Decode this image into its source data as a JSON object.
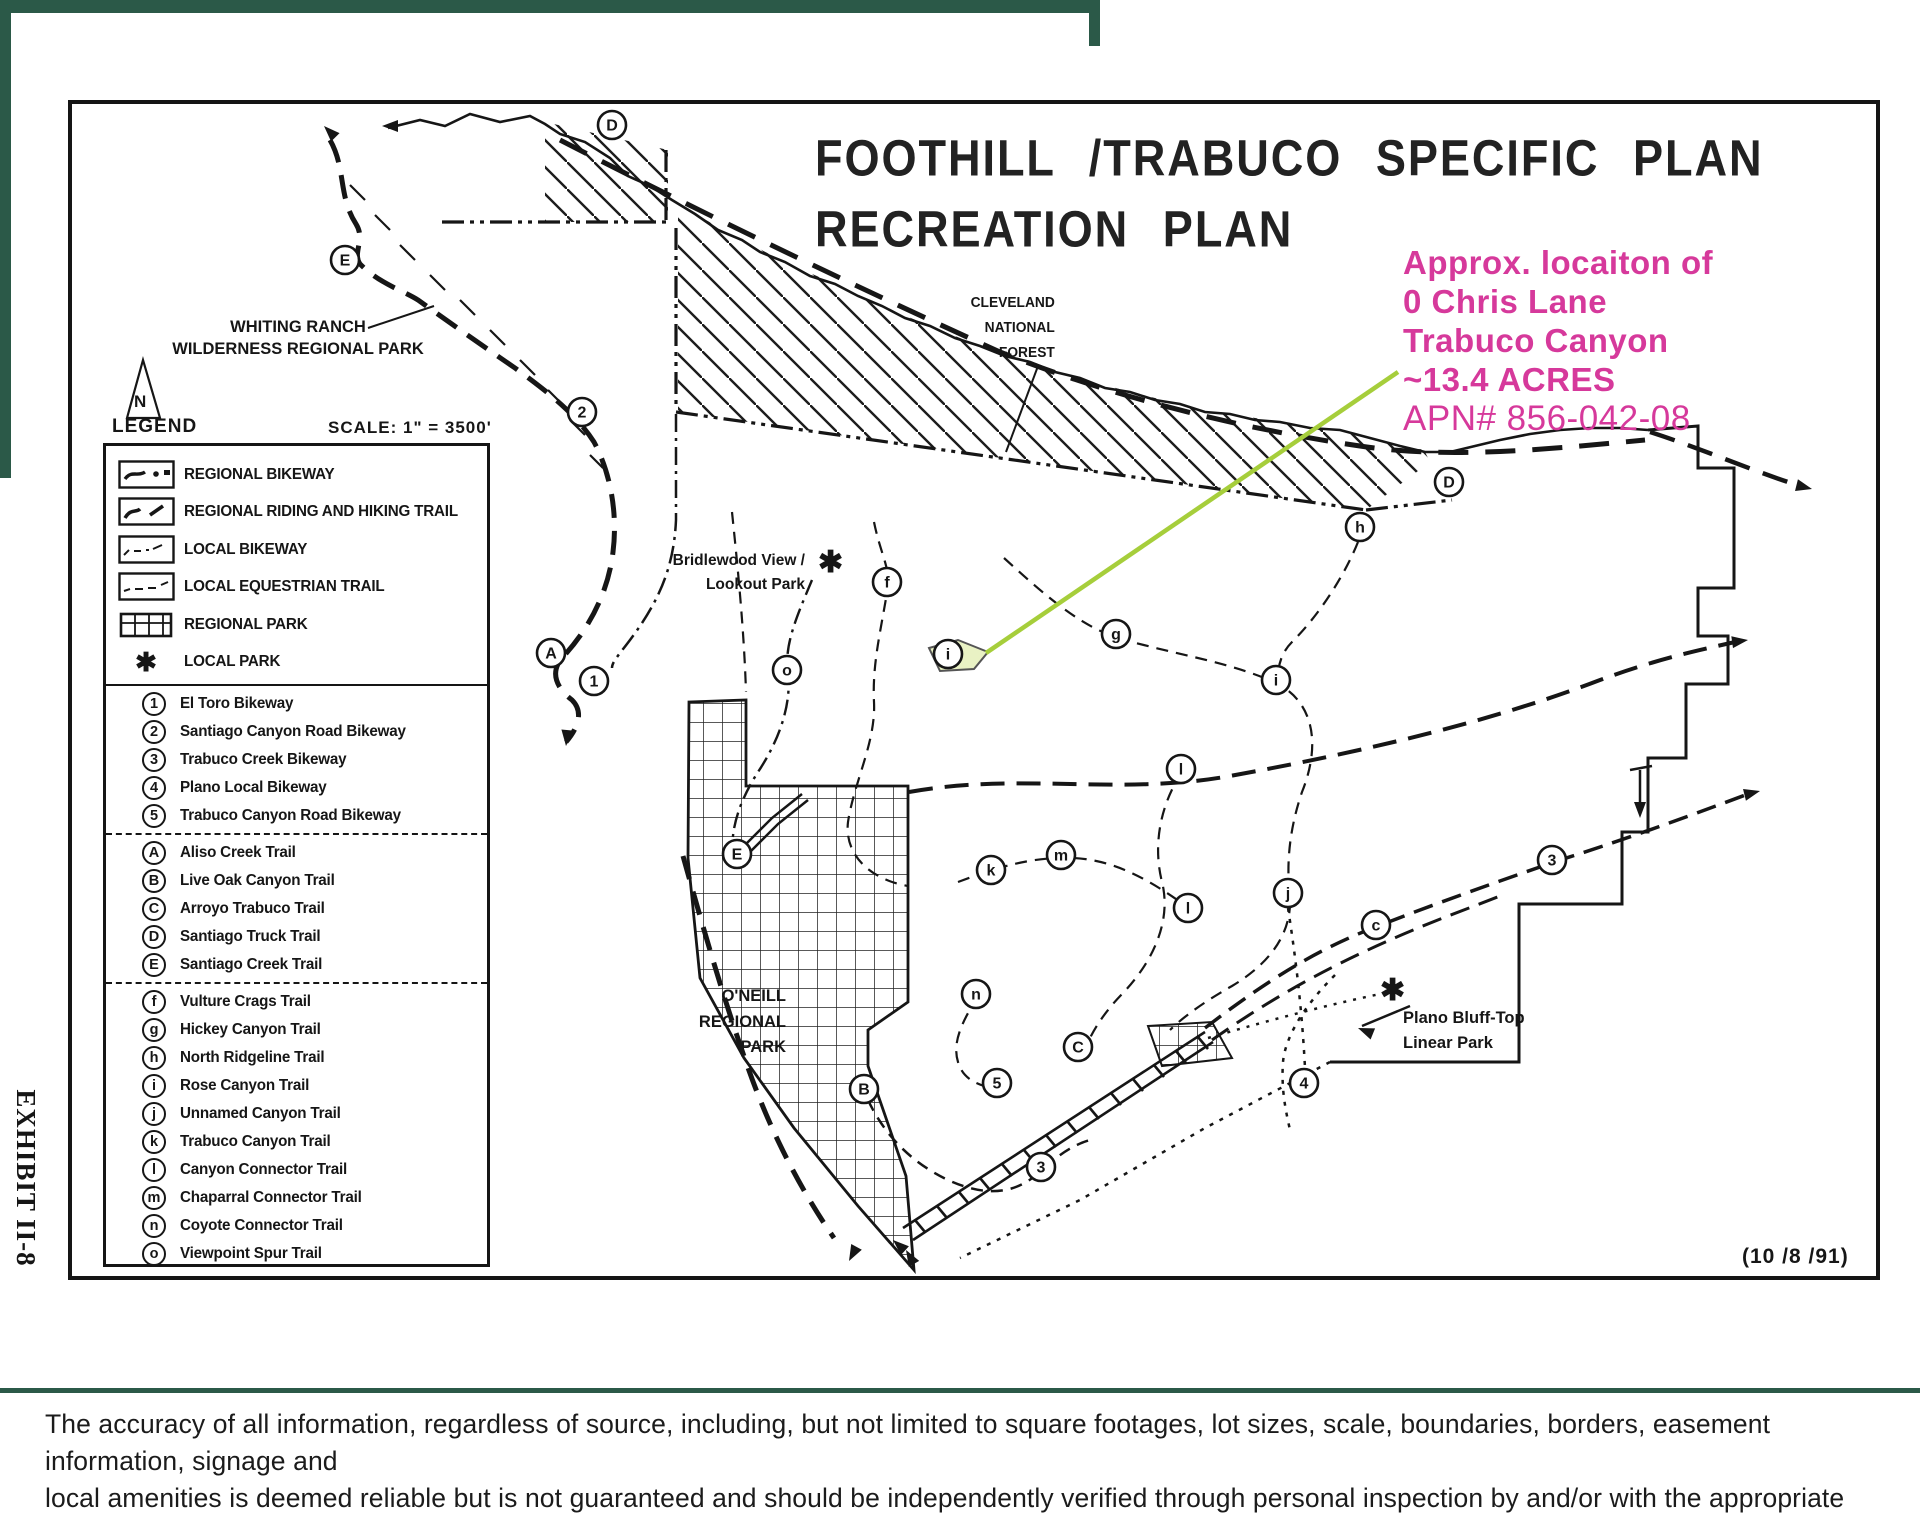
{
  "title": {
    "line1": "FOOTHILL /TRABUCO  SPECIFIC  PLAN",
    "line2": "RECREATION  PLAN"
  },
  "annotation": {
    "line1": "Approx. locaiton of",
    "line2": "0 Chris Lane",
    "line3": "Trabuco Canyon",
    "line4": "~13.4 ACRES",
    "line5": "APN# 856-042-08",
    "color": "#D6399B"
  },
  "map_labels": {
    "whiting_ranch": [
      "WHITING RANCH",
      "WILDERNESS REGIONAL PARK"
    ],
    "cleveland": [
      "CLEVELAND",
      "NATIONAL",
      "FOREST"
    ],
    "bridlewood": [
      "Bridlewood View /",
      "Lookout Park"
    ],
    "oneill": [
      "O'NEILL",
      "REGIONAL",
      "PARK"
    ],
    "plano": [
      "Plano Bluff-Top",
      "Linear Park"
    ],
    "date": "(10 /8 /91)",
    "north": "N"
  },
  "legend": {
    "title": "LEGEND",
    "scale": "SCALE: 1\" =  3500'",
    "symbol_items": [
      {
        "symbol": "regional-bikeway",
        "label": "REGIONAL BIKEWAY"
      },
      {
        "symbol": "riding-hiking-trail",
        "label": "REGIONAL RIDING AND HIKING TRAIL"
      },
      {
        "symbol": "local-bikeway",
        "label": "LOCAL BIKEWAY"
      },
      {
        "symbol": "local-equestrian",
        "label": "LOCAL EQUESTRIAN TRAIL"
      },
      {
        "symbol": "regional-park",
        "label": "REGIONAL PARK"
      },
      {
        "symbol": "local-park",
        "label": "LOCAL PARK"
      }
    ],
    "bikeways": [
      {
        "id": "1",
        "label": "El Toro Bikeway"
      },
      {
        "id": "2",
        "label": "Santiago Canyon Road Bikeway"
      },
      {
        "id": "3",
        "label": "Trabuco Creek Bikeway"
      },
      {
        "id": "4",
        "label": "Plano Local Bikeway"
      },
      {
        "id": "5",
        "label": "Trabuco Canyon Road Bikeway"
      }
    ],
    "regional_trails": [
      {
        "id": "A",
        "label": "Aliso Creek Trail"
      },
      {
        "id": "B",
        "label": "Live Oak Canyon Trail"
      },
      {
        "id": "C",
        "label": "Arroyo Trabuco Trail"
      },
      {
        "id": "D",
        "label": "Santiago Truck Trail"
      },
      {
        "id": "E",
        "label": "Santiago Creek Trail"
      }
    ],
    "local_trails": [
      {
        "id": "f",
        "label": "Vulture Crags Trail"
      },
      {
        "id": "g",
        "label": "Hickey Canyon Trail"
      },
      {
        "id": "h",
        "label": "North Ridgeline Trail"
      },
      {
        "id": "i",
        "label": "Rose Canyon Trail"
      },
      {
        "id": "j",
        "label": "Unnamed Canyon Trail"
      },
      {
        "id": "k",
        "label": "Trabuco Canyon Trail"
      },
      {
        "id": "l",
        "label": "Canyon Connector Trail"
      },
      {
        "id": "m",
        "label": "Chaparral Connector Trail"
      },
      {
        "id": "n",
        "label": "Coyote Connector Trail"
      },
      {
        "id": "o",
        "label": "Viewpoint Spur Trail"
      }
    ]
  },
  "map_markers": [
    {
      "label": "D",
      "x": 612,
      "y": 125
    },
    {
      "label": "E",
      "x": 345,
      "y": 260
    },
    {
      "label": "2",
      "x": 582,
      "y": 412
    },
    {
      "label": "A",
      "x": 551,
      "y": 653
    },
    {
      "label": "1",
      "x": 594,
      "y": 681
    },
    {
      "label": "E",
      "x": 737,
      "y": 854
    },
    {
      "label": "o",
      "x": 787,
      "y": 670
    },
    {
      "label": "f",
      "x": 887,
      "y": 582
    },
    {
      "label": "i",
      "x": 948,
      "y": 654
    },
    {
      "label": "g",
      "x": 1116,
      "y": 634
    },
    {
      "label": "h",
      "x": 1360,
      "y": 527
    },
    {
      "label": "D",
      "x": 1449,
      "y": 482
    },
    {
      "label": "i",
      "x": 1276,
      "y": 680
    },
    {
      "label": "l",
      "x": 1181,
      "y": 769
    },
    {
      "label": "k",
      "x": 991,
      "y": 870
    },
    {
      "label": "m",
      "x": 1061,
      "y": 855
    },
    {
      "label": "l",
      "x": 1188,
      "y": 908
    },
    {
      "label": "j",
      "x": 1288,
      "y": 893
    },
    {
      "label": "c",
      "x": 1376,
      "y": 925
    },
    {
      "label": "3",
      "x": 1552,
      "y": 860
    },
    {
      "label": "n",
      "x": 976,
      "y": 994
    },
    {
      "label": "C",
      "x": 1078,
      "y": 1047
    },
    {
      "label": "5",
      "x": 997,
      "y": 1083
    },
    {
      "label": "B",
      "x": 864,
      "y": 1089
    },
    {
      "label": "3",
      "x": 1041,
      "y": 1167
    },
    {
      "label": "4",
      "x": 1304,
      "y": 1083
    }
  ],
  "exhibit_label": "EXHIBIT II-8",
  "disclaimer": {
    "line1": "The accuracy of all information, regardless of source, including, but not limited to square footages, lot sizes, scale, boundaries, borders, easement information, signage and",
    "line2": "local amenities is deemed reliable but is not guaranteed and should be independently verified through personal inspection by and/or with the appropriate professionals.",
    "line3": "Property listings are subject to errors, omissions, prior sales or withdrawal without notice."
  },
  "colors": {
    "pink": "#D6399B",
    "frame_green": "#2B5948",
    "callout_green": "#A6CE3B",
    "parcel_fill": "#E9F2C4",
    "ink": "#161616"
  }
}
